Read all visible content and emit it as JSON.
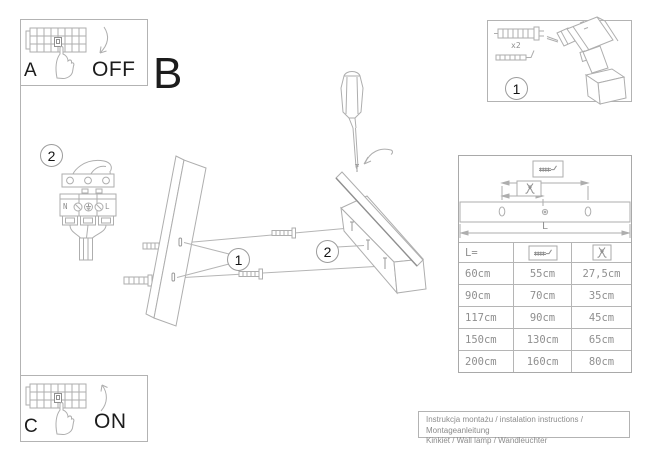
{
  "colors": {
    "line": "#aeaeae",
    "text_dark": "#1c1c1c",
    "text_gray": "#8f8f8f"
  },
  "panel_a": {
    "label": "A",
    "state": "OFF"
  },
  "panel_b": {
    "label": "B"
  },
  "panel_c": {
    "label": "C",
    "state": "ON"
  },
  "step1": {
    "number": "1",
    "qty": "x2"
  },
  "step2": {
    "number": "2"
  },
  "assembly": {
    "step1_ref": "1",
    "step2_ref": "2"
  },
  "terminal_block": {
    "neutral": "N",
    "live": "L"
  },
  "dimension_diagram": {
    "length_label": "L"
  },
  "size_table": {
    "columns": [
      "L=",
      "screw-spacing-icon",
      "wire-offset-icon"
    ],
    "rows": [
      [
        "60cm",
        "55cm",
        "27,5cm"
      ],
      [
        "90cm",
        "70cm",
        "35cm"
      ],
      [
        "117cm",
        "90cm",
        "45cm"
      ],
      [
        "150cm",
        "130cm",
        "65cm"
      ],
      [
        "200cm",
        "160cm",
        "80cm"
      ]
    ]
  },
  "caption": {
    "line1": "Instrukcja montażu / instalation instructions / Montageanleitung",
    "line2": "Kinkiet / Wall lamp / Wandleuchter"
  }
}
